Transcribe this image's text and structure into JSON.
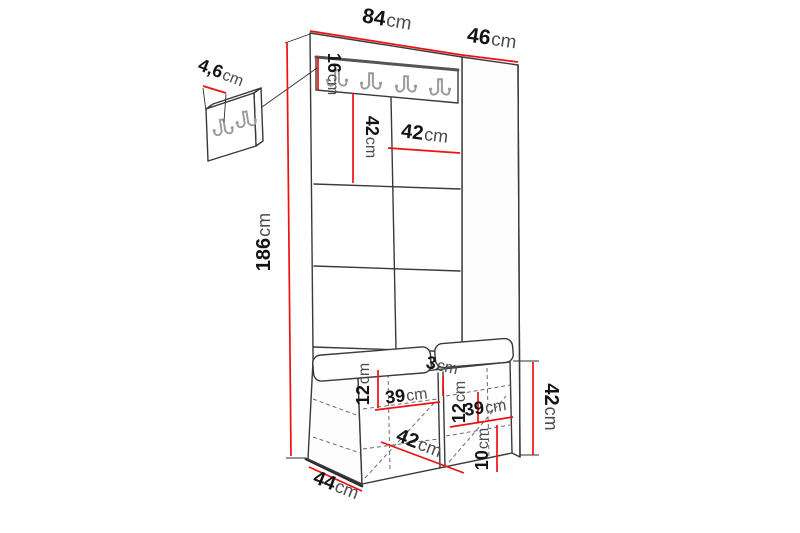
{
  "diagram": {
    "description": "Hall unit / hallway furniture dimension diagram with coat hooks, padded wall panels and a bench with storage",
    "dimensions": {
      "overall_width": {
        "value": "84",
        "unit": "cm"
      },
      "top_depth": {
        "value": "46",
        "unit": "cm"
      },
      "hook_detail_offset": {
        "value": "4,6",
        "unit": "cm"
      },
      "hook_board_height": {
        "value": "16",
        "unit": "cm"
      },
      "panel_row_height": {
        "value": "42",
        "unit": "cm"
      },
      "panel_column_width": {
        "value": "42",
        "unit": "cm"
      },
      "total_height": {
        "value": "186",
        "unit": "cm"
      },
      "divider_thickness": {
        "value": "3",
        "unit": "cm"
      },
      "left_shelf_height": {
        "value": "12",
        "unit": "cm"
      },
      "left_compartment_width": {
        "value": "39",
        "unit": "cm"
      },
      "right_shelf_height": {
        "value": "12",
        "unit": "cm"
      },
      "right_compartment_width": {
        "value": "39",
        "unit": "cm"
      },
      "bench_inner_depth": {
        "value": "42",
        "unit": "cm"
      },
      "bottom_section_height": {
        "value": "10",
        "unit": "cm"
      },
      "base_depth": {
        "value": "44",
        "unit": "cm"
      },
      "bench_height": {
        "value": "42",
        "unit": "cm"
      }
    },
    "colors": {
      "dimension_line": "#ee1111",
      "outline": "#3a3a3a",
      "hook": "#9a9a9a",
      "value_text": "#141414",
      "unit_text": "#4d4d4d"
    }
  }
}
